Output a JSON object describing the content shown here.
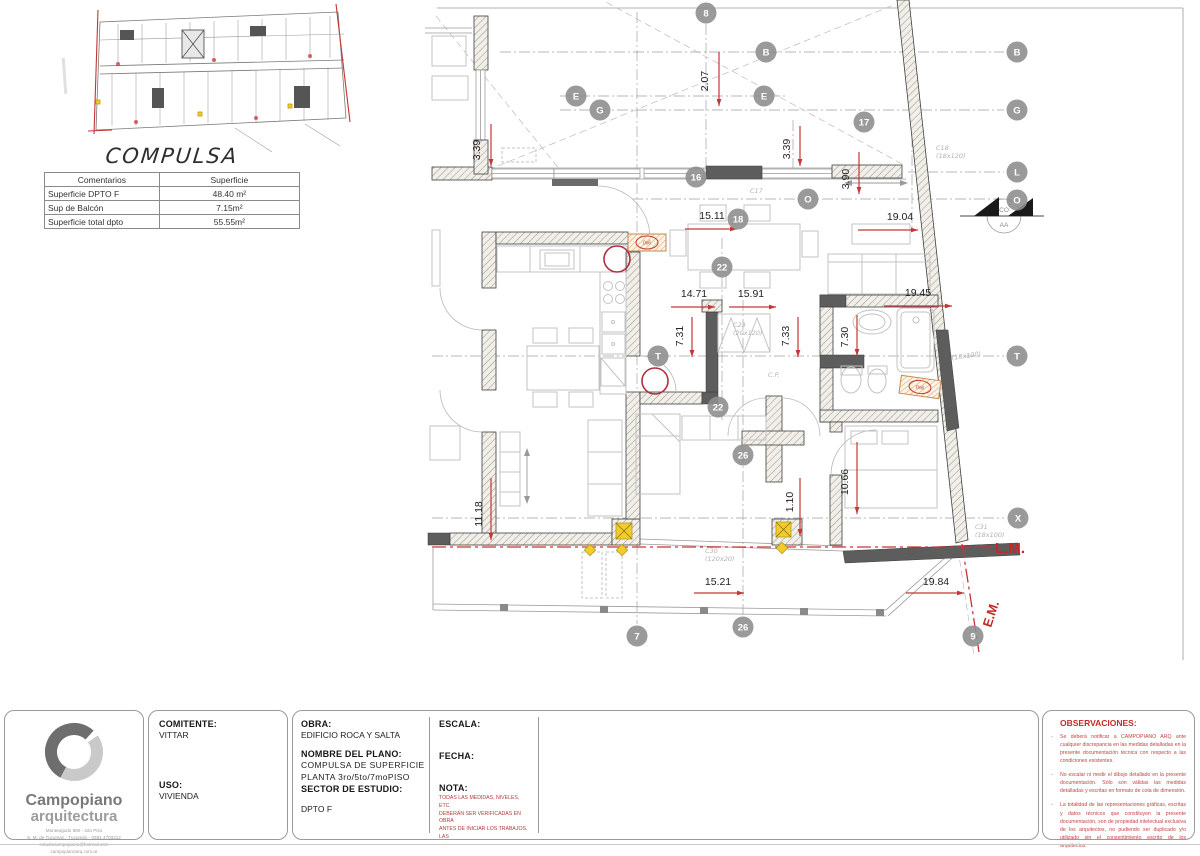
{
  "compulsa": {
    "title": "COMPULSA",
    "table": {
      "headers": [
        "Comentarios",
        "Superficie"
      ],
      "rows": [
        [
          "Superficie DPTO F",
          "48.40 m²"
        ],
        [
          "Sup de Balcón",
          "7.15m²"
        ],
        [
          "Superficie total dpto",
          "55.55m²"
        ]
      ]
    }
  },
  "plan": {
    "col_marker": "0x6",
    "section": {
      "top": "CO",
      "bottom": "AA"
    },
    "bubbles": [
      {
        "t": "8",
        "x": 706,
        "y": 13
      },
      {
        "t": "B",
        "x": 766,
        "y": 52
      },
      {
        "t": "B",
        "x": 1017,
        "y": 52
      },
      {
        "t": "E",
        "x": 576,
        "y": 96
      },
      {
        "t": "E",
        "x": 764,
        "y": 96
      },
      {
        "t": "G",
        "x": 600,
        "y": 110
      },
      {
        "t": "G",
        "x": 1017,
        "y": 110
      },
      {
        "t": "17",
        "x": 864,
        "y": 122
      },
      {
        "t": "16",
        "x": 696,
        "y": 177
      },
      {
        "t": "L",
        "x": 1017,
        "y": 172
      },
      {
        "t": "O",
        "x": 808,
        "y": 199
      },
      {
        "t": "O",
        "x": 1017,
        "y": 200
      },
      {
        "t": "18",
        "x": 738,
        "y": 219
      },
      {
        "t": "22",
        "x": 722,
        "y": 267
      },
      {
        "t": "T",
        "x": 658,
        "y": 356
      },
      {
        "t": "T",
        "x": 1017,
        "y": 356
      },
      {
        "t": "22",
        "x": 718,
        "y": 407
      },
      {
        "t": "26",
        "x": 743,
        "y": 455
      },
      {
        "t": "X",
        "x": 1018,
        "y": 518
      },
      {
        "t": "7",
        "x": 637,
        "y": 636
      },
      {
        "t": "26",
        "x": 743,
        "y": 627
      },
      {
        "t": "9",
        "x": 973,
        "y": 636
      }
    ],
    "dims": [
      {
        "t": "2.07",
        "x": 708,
        "y": 81,
        "v": true,
        "a": [
          719,
          52,
          719,
          106
        ]
      },
      {
        "t": "3.39",
        "x": 480,
        "y": 150,
        "v": true,
        "a": [
          491,
          124,
          491,
          166
        ]
      },
      {
        "t": "3.39",
        "x": 790,
        "y": 149,
        "v": true,
        "a": [
          800,
          126,
          800,
          166
        ]
      },
      {
        "t": "3.90",
        "x": 849,
        "y": 179,
        "v": true,
        "a": [
          859,
          152,
          859,
          194
        ]
      },
      {
        "t": "15.11",
        "x": 712,
        "y": 219,
        "a": [
          685,
          229,
          737,
          229
        ]
      },
      {
        "t": "19.04",
        "x": 900,
        "y": 220,
        "a": [
          858,
          230,
          918,
          230
        ]
      },
      {
        "t": "14.71",
        "x": 694,
        "y": 297,
        "a": [
          671,
          307,
          715,
          307
        ]
      },
      {
        "t": "15.91",
        "x": 751,
        "y": 297,
        "a": [
          729,
          307,
          776,
          307
        ]
      },
      {
        "t": "19.45",
        "x": 918,
        "y": 296,
        "a": [
          884,
          306,
          952,
          306
        ]
      },
      {
        "t": "7.31",
        "x": 683,
        "y": 336,
        "v": true,
        "a": [
          692,
          317,
          692,
          357
        ]
      },
      {
        "t": "7.33",
        "x": 789,
        "y": 336,
        "v": true,
        "a": [
          798,
          317,
          798,
          357
        ]
      },
      {
        "t": "7.30",
        "x": 848,
        "y": 337,
        "v": true,
        "a": [
          857,
          315,
          857,
          356
        ]
      },
      {
        "t": "11.18",
        "x": 482,
        "y": 514,
        "v": true,
        "a": [
          491,
          478,
          491,
          540
        ]
      },
      {
        "t": "10.66",
        "x": 848,
        "y": 482,
        "v": true,
        "a": [
          857,
          442,
          857,
          514
        ]
      },
      {
        "t": "1.10",
        "x": 793,
        "y": 502,
        "v": true,
        "a": [
          800,
          478,
          800,
          536
        ]
      },
      {
        "t": "15.21",
        "x": 718,
        "y": 585,
        "a": [
          694,
          593,
          744,
          593
        ]
      },
      {
        "t": "19.84",
        "x": 936,
        "y": 585,
        "a": [
          906,
          593,
          964,
          593
        ]
      }
    ],
    "labels": [
      {
        "t": "C18",
        "x": 936,
        "y": 150
      },
      {
        "t": "(18x120)",
        "x": 936,
        "y": 158
      },
      {
        "t": "C17",
        "x": 750,
        "y": 193
      },
      {
        "t": "C23",
        "x": 733,
        "y": 327
      },
      {
        "t": "(20x120)",
        "x": 733,
        "y": 335
      },
      {
        "t": "C.P.",
        "x": 768,
        "y": 377
      },
      {
        "t": "C30",
        "x": 705,
        "y": 553
      },
      {
        "t": "(120x20)",
        "x": 705,
        "y": 561
      },
      {
        "t": "(18x100)",
        "x": 952,
        "y": 360,
        "r": -8
      },
      {
        "t": "C31",
        "x": 975,
        "y": 529
      },
      {
        "t": "(18x100)",
        "x": 975,
        "y": 537
      },
      {
        "t": "L.M.",
        "x": 995,
        "y": 553,
        "c": "#c42727",
        "s": 15
      },
      {
        "t": "E.M.",
        "x": 991,
        "y": 628,
        "c": "#c42727",
        "s": 13,
        "r": -72
      }
    ]
  },
  "titleblock": {
    "logo": {
      "name_line1": "Campopiano",
      "name_line2": "arquitectura",
      "address": [
        "Monteagudo 890 - 2do Piso",
        "S. M. de Tucumán - Tucumán - 0381 4703212",
        "estudiocampopiano@hotmail.com",
        "campopianoarq.com.ar"
      ]
    },
    "comitente_label": "COMITENTE:",
    "comitente": "VITTAR",
    "uso_label": "USO:",
    "uso": "VIVIENDA",
    "obra_label": "OBRA:",
    "obra": "EDIFICIO ROCA Y SALTA",
    "plano_label": "NOMBRE DEL PLANO:",
    "plano_line1": "COMPULSA DE  SUPERFICIE",
    "plano_line2": "PLANTA 3ro/5to/7moPISO",
    "sector_label": "SECTOR DE ESTUDIO:",
    "sector": "DPTO F",
    "escala_label": "ESCALA:",
    "fecha_label": "FECHA:",
    "nota_label": "NOTA:",
    "nota_lines": [
      "TODAS LAS MEDIDAS, NIVELES, ETC.",
      "DEBERÁN SER VERIFICADAS EN OBRA",
      "ANTES DE INICIAR LOS TRABAJOS.",
      "LAS"
    ],
    "obs_label": "OBSERVACIONES:",
    "obs_items": [
      "Se deberá notificar a CAMPOPIANO ARQ ante cualquier discrepancia en las medidas detalladas en la presente documentación técnica con respecto a las condiciones existentes.",
      "No escalar ni medir el dibujo detallado en la presente documentación. Sólo son válidas las medidas detalladas y escritas en formato de cota de dimensión.",
      "La totalidad de las representaciones gráficas, escritas y datos técnicos que constituyen la presente documentación, son de propiedad intelectual exclusiva de los arquitectos, no pudiendo ser duplicado y/o utilizado sin el consentimiento escrito de los arquitectos."
    ]
  },
  "colors": {
    "accent_red": "#c63434",
    "bubble_grey": "#8f8f8f",
    "marker_yellow": "#f2cc2e",
    "marker_orange": "#c58a4a"
  }
}
